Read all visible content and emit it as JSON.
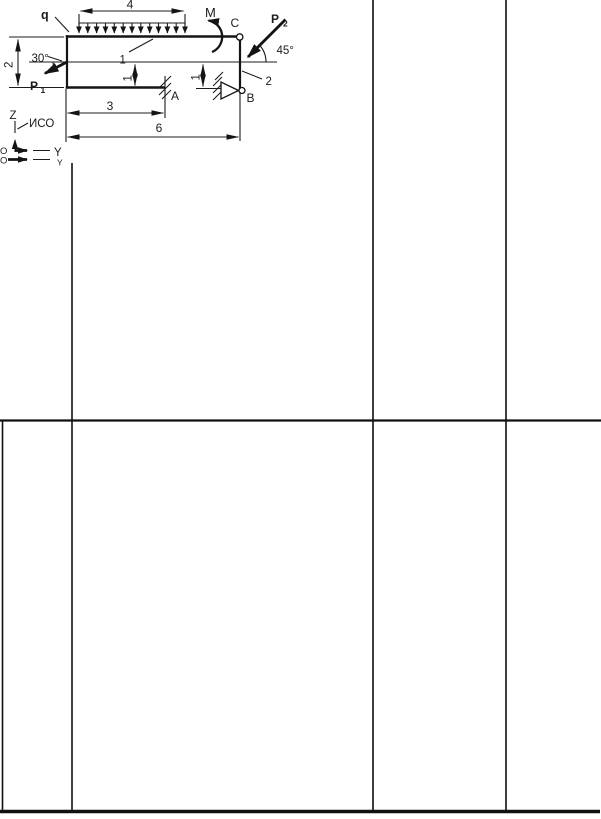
{
  "page": {
    "colors": {
      "paper": "#ffffff",
      "ink": "#1c1c1c"
    }
  },
  "diagram": {
    "loads": {
      "distributed_load": "q",
      "moment": "M",
      "force_p1_base": "P",
      "force_p1_sub": "1",
      "force_p2_base": "P",
      "force_p2_sub": "2"
    },
    "angles": {
      "left": "30°",
      "right": "45°"
    },
    "dimensions": {
      "top_span": "4",
      "left_height": "2",
      "mid_left": "1",
      "mid_right": "1",
      "bottom_short": "3",
      "bottom_long": "6"
    },
    "points": {
      "c": "C",
      "support_a": "A",
      "support_b": "B"
    },
    "members": {
      "top_bar": "1",
      "right_column": "2"
    },
    "axes": {
      "z": "Z",
      "frame_name": "ИСО",
      "y_main": "Y",
      "y_ghost": "Y",
      "origin_main": "O",
      "origin_ghost": "O"
    }
  }
}
